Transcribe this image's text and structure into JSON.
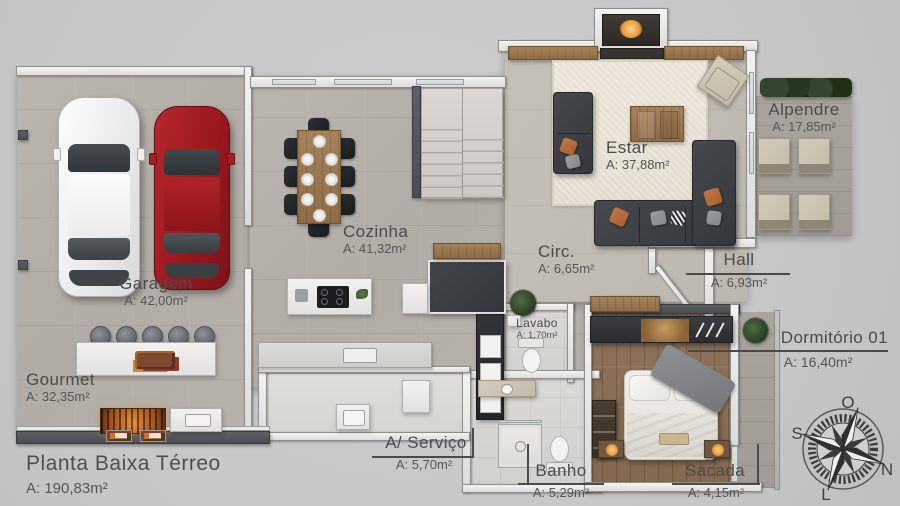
{
  "title": {
    "name": "Planta Baixa Térreo",
    "area": "A: 190,83m²"
  },
  "rooms": {
    "garagem": {
      "label": "Garagem",
      "area": "A: 42,00m²"
    },
    "gourmet": {
      "label": "Gourmet",
      "area": "A: 32,35m²"
    },
    "cozinha": {
      "label": "Cozinha",
      "area": "A: 41,32m²"
    },
    "estar": {
      "label": "Estar",
      "area": "A: 37,88m²"
    },
    "alpendre": {
      "label": "Alpendre",
      "area": "A: 17,85m²"
    },
    "circ": {
      "label": "Circ.",
      "area": "A: 6,65m²"
    },
    "hall": {
      "label": "Hall",
      "area": "A: 6,93m²"
    },
    "lavabo": {
      "label": "Lavabo",
      "area": "A: 1,70m²"
    },
    "dormitorio": {
      "label": "Dormitório 01",
      "area": "A: 16,40m²"
    },
    "servico": {
      "label": "A/ Serviço",
      "area": "A: 5,70m²"
    },
    "banho": {
      "label": "Banho",
      "area": "A: 5,29m²"
    },
    "sacada": {
      "label": "Sacada",
      "area": "A: 4,15m²"
    }
  },
  "compass": {
    "n": "N",
    "s": "S",
    "e": "L",
    "w": "O"
  },
  "colors": {
    "background": "#c9c9c9",
    "floor_concrete": "#b7b3ac",
    "floor_wood": "#8f7459",
    "wall_light": "#f1f0ee",
    "wall_dark": "#54585c",
    "car_red": "#9e1f24",
    "pillow_accent": "#b5673b",
    "text": "#4b4b4b"
  }
}
